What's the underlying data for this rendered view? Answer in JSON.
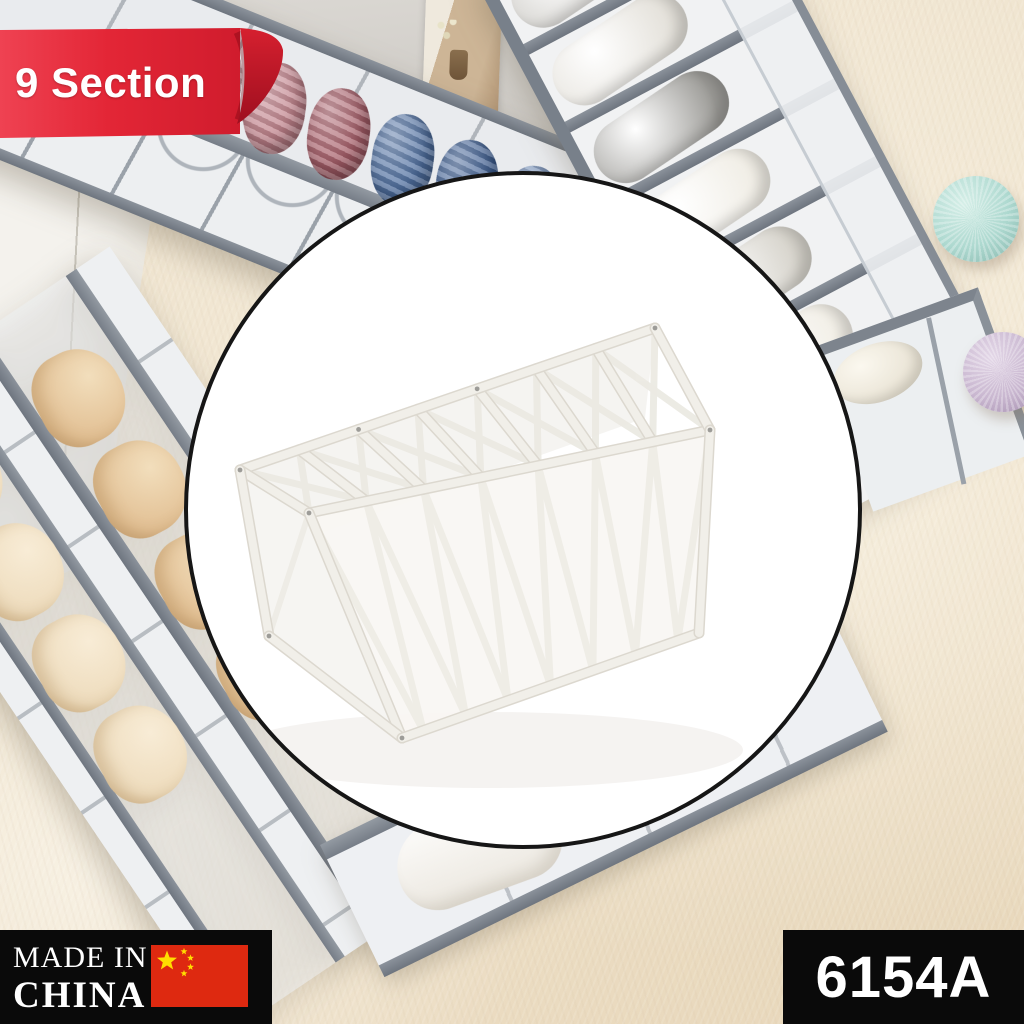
{
  "overlays": {
    "ribbon": {
      "label": "9 Section",
      "bg_color": "#e32636",
      "fold_color": "#9e0f1f",
      "text_color": "#ffffff"
    },
    "origin_badge": {
      "line1": "MADE IN",
      "line2": "CHINA",
      "bg_color": "#0a0a0a",
      "text_color": "#ffffff",
      "flag_icon": {
        "name": "china-flag-icon",
        "field_color": "#de2910",
        "star_color": "#ffde00"
      }
    },
    "sku_badge": {
      "label": "6154A",
      "bg_color": "#0a0a0a",
      "text_color": "#ffffff"
    }
  },
  "product_photo": {
    "item_name": "white-mesh-drawer-organizer",
    "compartments_visible": 7,
    "circle_bg": "#ffffff",
    "circle_border": "#161616",
    "trim_color": "#f1efe9",
    "trim_outline": "#dcd8cf"
  },
  "scene": {
    "wall_color": "#d6d3ce",
    "carpet_color": "#f0e5d0",
    "organizer_trim_color": "#7c838c",
    "mesh_color": "#edeff1",
    "clothes_rolls_top_left": [
      "#d9a8b0",
      "#c2838c",
      "#a85f6a",
      "#4f6fa0",
      "#3e5e92",
      "#7590ba",
      "#a3b4cf",
      "#e9e7e4"
    ],
    "rolls_top_right": [
      "#c9c7c2",
      "#e3e0d9",
      "#9b9a96",
      "#f0ede5",
      "#d6d3cb",
      "#f2efe7"
    ],
    "bra_color_dark": "#e2c094",
    "bra_color_light": "#eedcbd",
    "pompom_teal": "#aed9d0",
    "pompom_lavender": "#c9b7d0"
  }
}
